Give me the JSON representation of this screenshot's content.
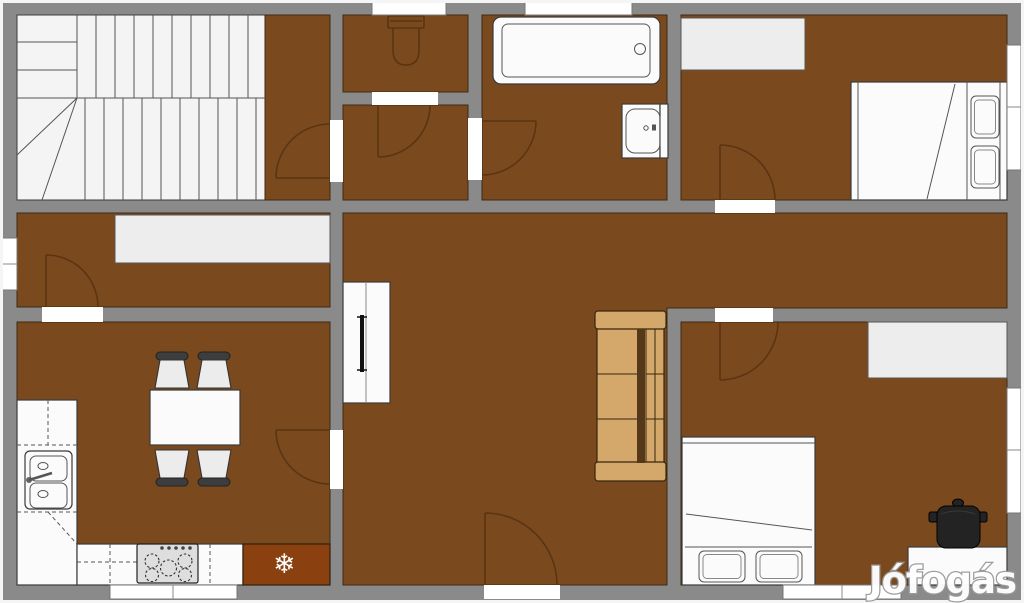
{
  "watermark": {
    "text": "Jófogás"
  },
  "icons": {
    "snowflake_glyph": "❄",
    "snowflake_name": "snowflake-icon"
  },
  "colors": {
    "wall": "#8a8a8a",
    "edge": "#f5f5f5",
    "floor": "#7a4a1e",
    "room_outline": "#3d2a12",
    "white_floor": "#f4f4f4",
    "stair_line": "#555555",
    "window": "#ffffff",
    "door": "#5a3413",
    "furniture_white": "#fbfbfb",
    "furniture_outline": "#3a3a3a",
    "wardrobe": "#ededed",
    "sofa": "#d4a76a",
    "sofa_dark": "#55381a",
    "sofa_outline": "#38260e",
    "fridge": "#8a400f",
    "chair_seat": "#ececec",
    "chair_back": "#3d3d3d",
    "tv": "#111111",
    "pot": "#232323",
    "watermark_fill": "#ffffff",
    "watermark_outline": "#9a9a9a"
  }
}
